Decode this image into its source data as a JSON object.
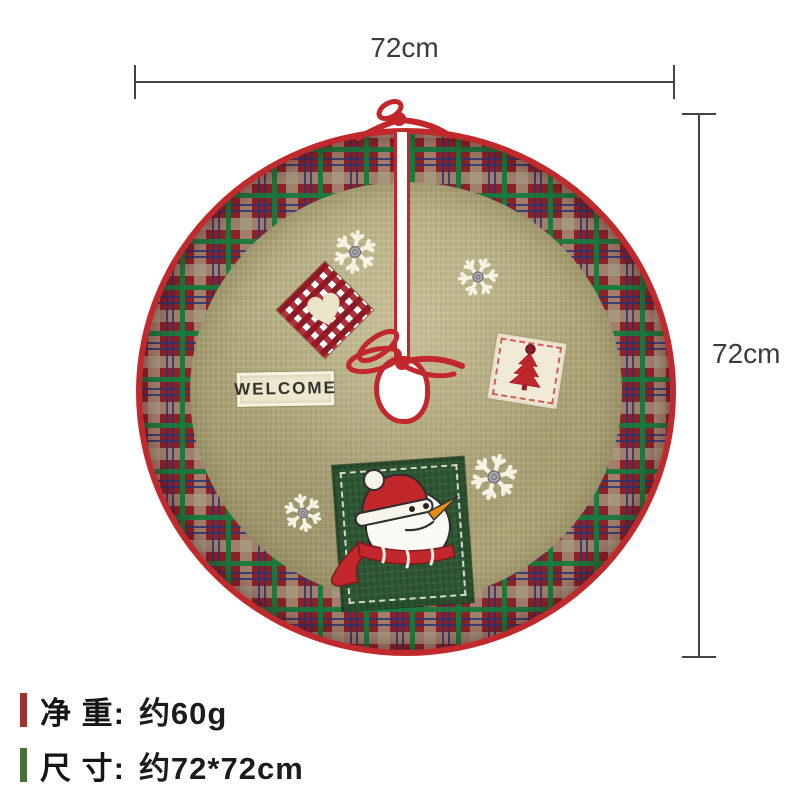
{
  "dimensions": {
    "top": {
      "label": "72cm"
    },
    "right": {
      "label": "72cm"
    }
  },
  "skirt": {
    "welcome_label": "WELCOME",
    "snowflake_count": 4,
    "colors": {
      "plaid_red": "#8e2127",
      "trim_red": "#c1272b",
      "burlap_tan": "#b2a97c",
      "patch_green": "#2d5733",
      "gingham_red": "#b01f28",
      "cream": "#efe7cd",
      "carrot_orange": "#e78c12"
    }
  },
  "specs": {
    "rows": [
      {
        "label": "净 重:",
        "value": "约60g",
        "bar_color": "#9a342c"
      },
      {
        "label": "尺 寸:",
        "value": "约72*72cm",
        "bar_color": "#47703c"
      }
    ]
  }
}
